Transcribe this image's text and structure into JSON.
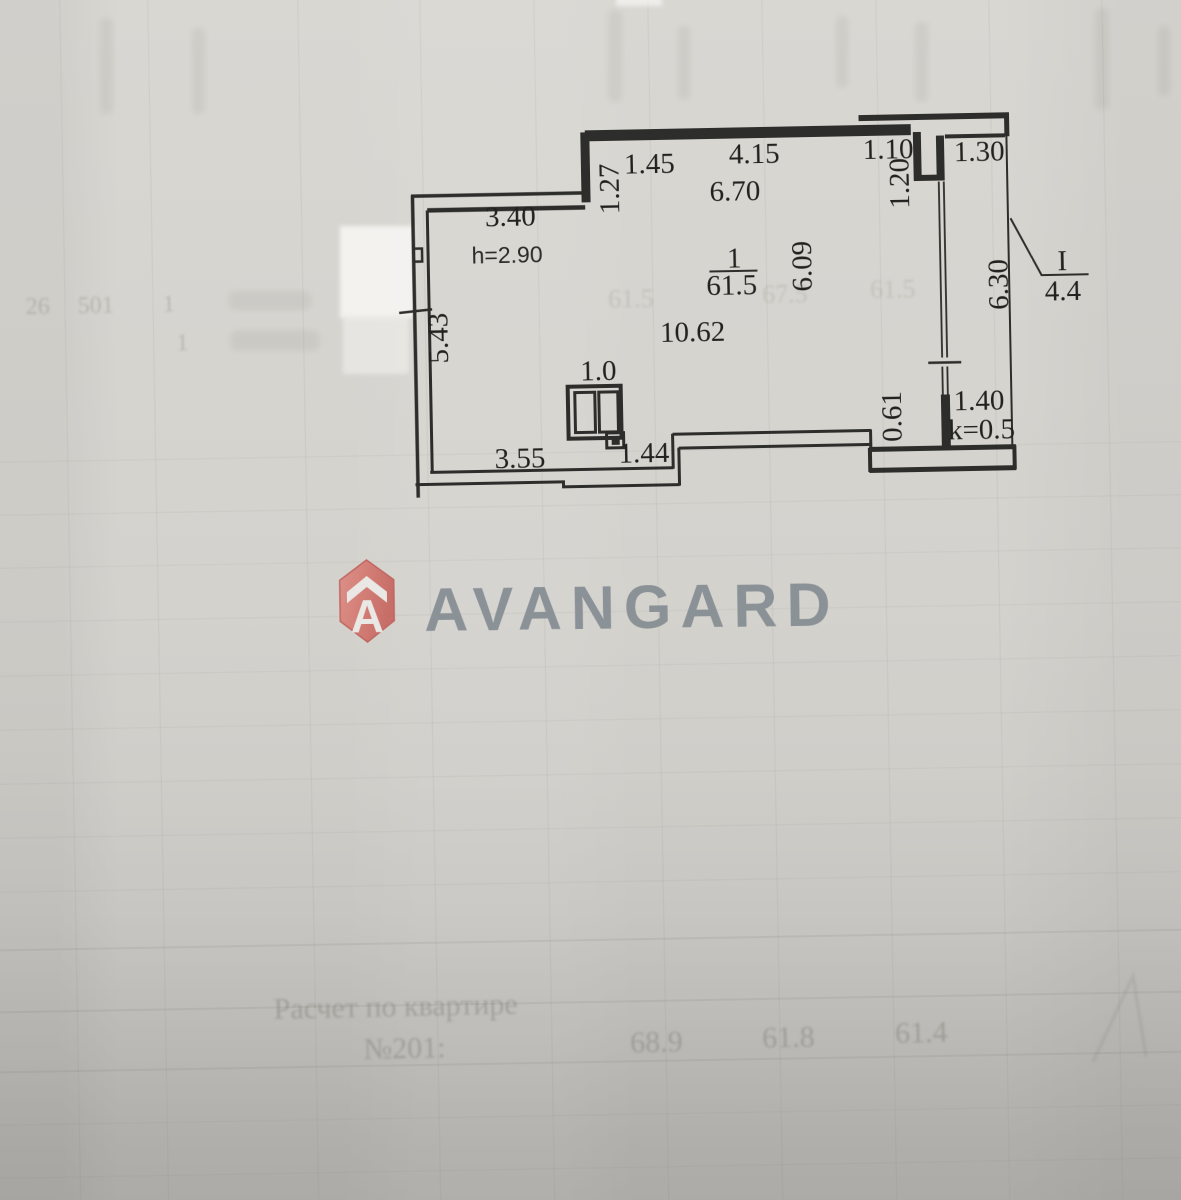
{
  "document": {
    "kind": "scanned apartment floor plan page"
  },
  "logo": {
    "brand": "AVANGARD",
    "icon": "house-badge",
    "badge_color": "#d2756d",
    "text_color": "#858c92"
  },
  "plan": {
    "room_number": "1",
    "room_area": "61.5",
    "ceiling_height": "h=2.90",
    "balcony_label": "I",
    "balcony_area": "4.4",
    "balcony_coefficient": "k=0.5",
    "dims": {
      "top_left_offset": "1.45",
      "top_window": "4.15",
      "top_opening": "1.10",
      "balcony_width": "1.30",
      "top_total": "6.70",
      "left_riser": "1.27",
      "pier_depth": "1.20",
      "upper_left_wall": "3.40",
      "room_depth_right": "6.09",
      "balcony_depth": "6.30",
      "room_width": "10.62",
      "left_wall": "5.43",
      "vent_width": "1.0",
      "bottom_left_wall": "3.55",
      "bottom_step": "1.44",
      "bottom_right_offset": "0.61",
      "balcony_door": "1.40"
    }
  },
  "bleedthrough": {
    "calc_line1": "Расчет по квартире",
    "calc_line2": "№201:",
    "calc_values": {
      "v1": "68.9",
      "v2": "61.8",
      "v3": "61.4"
    },
    "left_row": {
      "a": "26",
      "b": "501",
      "c": "1",
      "d": "1"
    },
    "mid_row": {
      "a": "61.5",
      "b": "67.5",
      "c": "61.5"
    }
  }
}
